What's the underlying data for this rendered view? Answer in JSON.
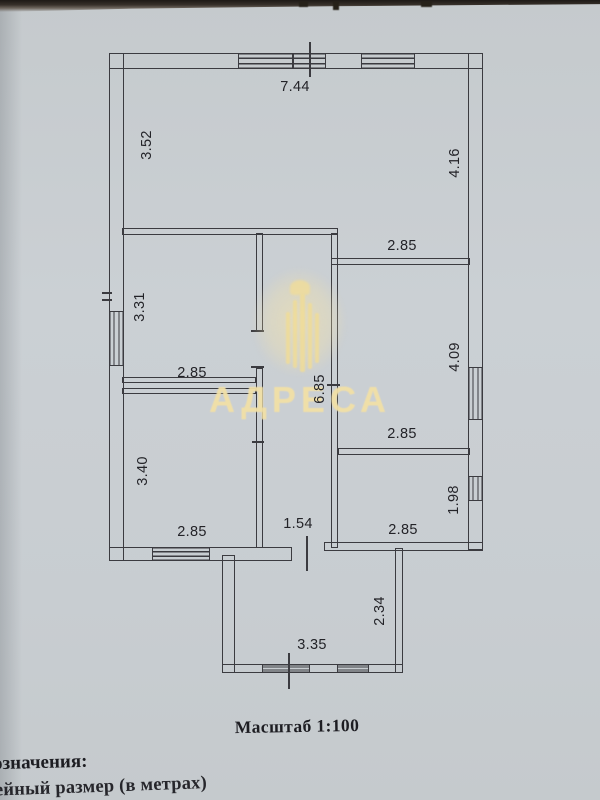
{
  "colors": {
    "paper": "#c9cdd1",
    "line": "#3b3b40",
    "watermark": "#f2e0a6",
    "page_edge": "#1d1916"
  },
  "watermark": {
    "text": "АДРЕСА"
  },
  "texts": {
    "scale": "Масштаб 1:100",
    "legend_heading": "означения:",
    "legend_item": "нейный размер (в метрах)"
  },
  "dims": {
    "top_width": "7.44",
    "upper_left_room_height": "3.52",
    "upper_right_room_height": "4.16",
    "upper_right_room_width": "2.85",
    "mid_left_room_height": "3.31",
    "mid_left_room_width": "2.85",
    "corridor_length": "6.85",
    "mid_right_room_height": "4.09",
    "mid_right_room_width": "2.85",
    "lower_left_room_height": "3.40",
    "lower_left_room_width": "2.85",
    "corridor_width": "1.54",
    "lower_right_room_width": "2.85",
    "lower_right_room_height": "1.98",
    "porch_depth": "2.34",
    "porch_width": "3.35"
  }
}
